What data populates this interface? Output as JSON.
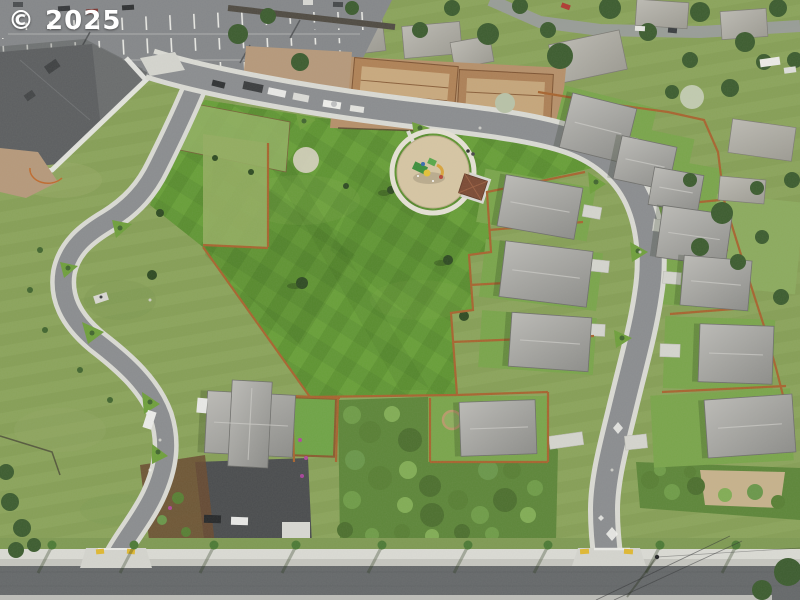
{
  "watermark": {
    "text": "© 2025"
  },
  "palette": {
    "lawn_green": "#679c38",
    "rough_grass": "#8aa35a",
    "asphalt_street": "#8b8d90",
    "asphalt_main_road": "#65686a",
    "concrete_sidewalk": "#dbdbd5",
    "roof_gray": "#9a9a97",
    "fence_cedar": "#a8642f",
    "construction_dirt": "#b6906a",
    "tree_green": "#3c5c2f",
    "playground_chips": "#d7c6a4",
    "shrub_green": "#5d8639",
    "curb_ramp_yellow": "#e0b832",
    "vehicle_white": "#ececea",
    "watermark_white": "#ffffff"
  }
}
